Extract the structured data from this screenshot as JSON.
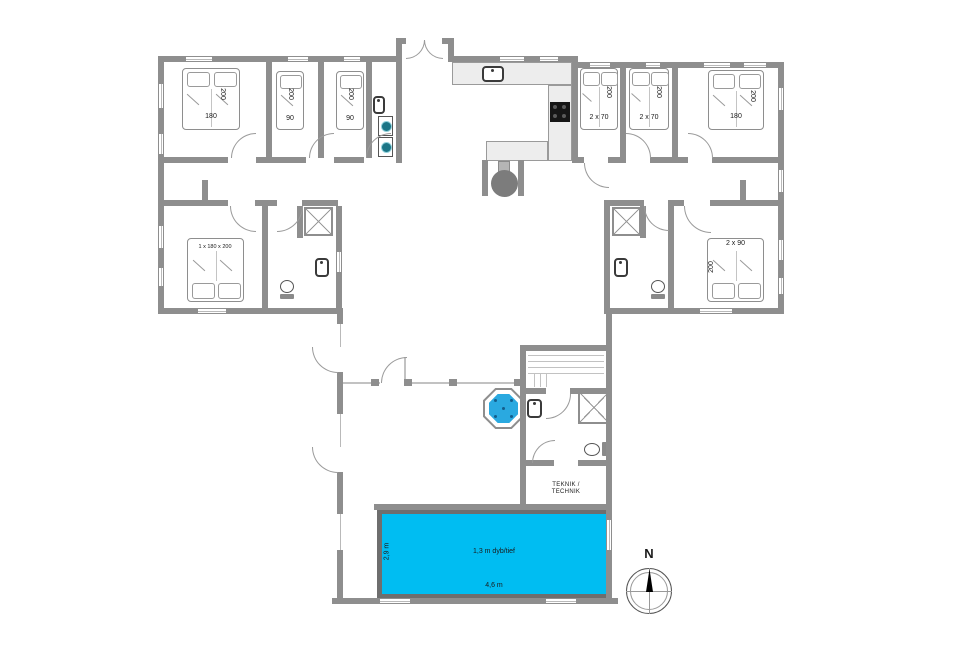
{
  "floorplan": {
    "bedrooms": [
      {
        "bed_size": "180",
        "bed_length": "200"
      },
      {
        "bed_size": "90",
        "bed_length": "200"
      },
      {
        "bed_size": "90",
        "bed_length": "200"
      },
      {
        "bed_size": "1 x 180 x 200"
      },
      {
        "bed_size": "2 x 70",
        "bed_length": "200"
      },
      {
        "bed_size": "2 x 70",
        "bed_length": "200"
      },
      {
        "bed_size": "180",
        "bed_length": "200"
      },
      {
        "bed_size": "2 x 90",
        "bed_length": "200"
      }
    ],
    "pool": {
      "depth_label": "1,3 m dyb/tief",
      "length_label": "4,6 m",
      "width_label": "2,9 m"
    },
    "technik_room": {
      "label_line1": "TEKNIK /",
      "label_line2": "TECHNIK"
    },
    "compass": {
      "north_label": "N"
    },
    "colors": {
      "wall": "#8e8e8e",
      "pool_water": "#00bdf2",
      "hot_tub_water": "#2aa9e0",
      "washer_accent": "#1b7586",
      "cooktop": "#161616"
    }
  }
}
